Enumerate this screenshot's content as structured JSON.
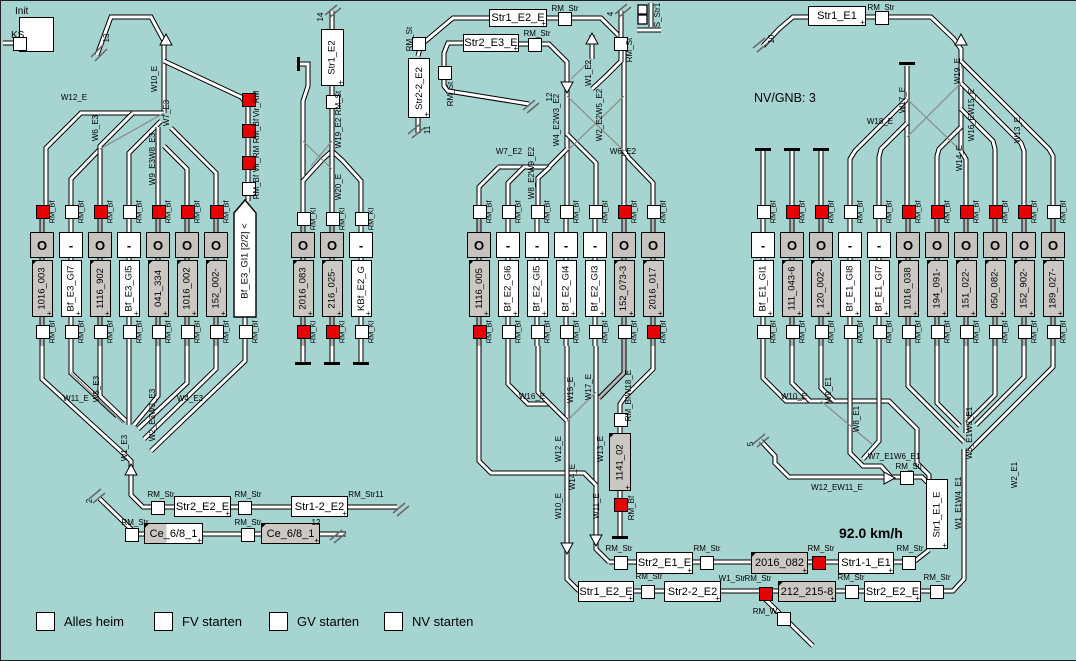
{
  "window": {
    "bg": "#a6d4d1",
    "accent_red": "#e60000",
    "track_gray": "#b3b3b3"
  },
  "controls": {
    "init": "Init",
    "ks": "KS",
    "buttons": [
      "Alles heim",
      "FV starten",
      "GV starten",
      "NV starten"
    ]
  },
  "texts": {
    "nv_gnb": "NV/GNB: 3",
    "speed": "92.0 km/h"
  },
  "deco": {
    "plus": "+",
    "wedge": "◤"
  },
  "stations": [
    {
      "id": "bf_e3",
      "x0": 41,
      "dx": 29,
      "y1": 204,
      "y2": 345,
      "sy": 210,
      "by": 330,
      "rm": "RM_Bf",
      "tracks": [
        {
          "label": "1016_003",
          "g": 1,
          "sig": "O",
          "top": "red",
          "bot": "white"
        },
        {
          "label": "Bf_E3_Gl7",
          "g": 0,
          "sig": "-",
          "top": "white",
          "bot": "white"
        },
        {
          "label": "1116_902",
          "g": 1,
          "sig": "O",
          "top": "red",
          "bot": "white"
        },
        {
          "label": "Bf_E3_Gl5",
          "g": 0,
          "sig": "-",
          "top": "white",
          "bot": "white"
        },
        {
          "label": "041_334",
          "g": 1,
          "sig": "O",
          "top": "red",
          "bot": "white"
        },
        {
          "label": "1016_002",
          "g": 1,
          "sig": "O",
          "top": "red",
          "bot": "white"
        },
        {
          "label": "152_002-",
          "g": 1,
          "sig": "O",
          "top": "red",
          "bot": "white"
        },
        {
          "label": "Bf_E3_Gl1 [2/2] <",
          "g": 0,
          "sig": "none",
          "top": "none",
          "bot": "white",
          "pent": 1
        }
      ]
    },
    {
      "id": "kbf_e2",
      "x0": 302,
      "dx": 29,
      "y1": 217,
      "y2": 345,
      "sy": 217,
      "by": 330,
      "rm": "RM_Kl",
      "tracks": [
        {
          "label": "2016_083",
          "g": 1,
          "sig": "O",
          "top": "white",
          "bot": "red"
        },
        {
          "label": "216_025-",
          "g": 1,
          "sig": "O",
          "top": "white",
          "bot": "red"
        },
        {
          "label": "KBf_E2_G",
          "g": 0,
          "sig": "-",
          "top": "white",
          "bot": "white"
        }
      ]
    },
    {
      "id": "bf_e2",
      "x0": 478,
      "dx": 29,
      "y1": 204,
      "y2": 345,
      "sy": 210,
      "by": 330,
      "rm": "RM_Bf",
      "tracks": [
        {
          "label": "1116_005",
          "g": 1,
          "sig": "O",
          "top": "white",
          "bot": "red"
        },
        {
          "label": "Bf_E2_Gl6",
          "g": 0,
          "sig": "-",
          "top": "white",
          "bot": "white"
        },
        {
          "label": "Bf_E2_Gl5",
          "g": 0,
          "sig": "-",
          "top": "white",
          "bot": "white"
        },
        {
          "label": "Bf_E2_Gl4",
          "g": 0,
          "sig": "-",
          "top": "white",
          "bot": "white"
        },
        {
          "label": "Bf_E2_Gl3",
          "g": 0,
          "sig": "-",
          "top": "white",
          "bot": "white"
        },
        {
          "label": "152_073-3",
          "g": 1,
          "sig": "O",
          "top": "red",
          "bot": "white"
        },
        {
          "label": "2016_017",
          "g": 1,
          "sig": "O",
          "top": "white",
          "bot": "red"
        }
      ]
    },
    {
      "id": "bf_e1",
      "x0": 762,
      "dx": 29,
      "y1": 204,
      "y2": 345,
      "sy": 210,
      "by": 330,
      "rm": "RM_Bf",
      "tracks": [
        {
          "label": "Bf_E1_Gl1",
          "g": 0,
          "sig": "-",
          "top": "white",
          "bot": "white"
        },
        {
          "label": "111_043-6",
          "g": 1,
          "sig": "O",
          "top": "red",
          "bot": "white"
        },
        {
          "label": "120_002-",
          "g": 1,
          "sig": "O",
          "top": "red",
          "bot": "white"
        },
        {
          "label": "Bf_E1_Gl8",
          "g": 0,
          "sig": "-",
          "top": "white",
          "bot": "white"
        },
        {
          "label": "Bf_E1_Gl7",
          "g": 0,
          "sig": "-",
          "top": "white",
          "bot": "white"
        },
        {
          "label": "1016_038",
          "g": 1,
          "sig": "O",
          "top": "red",
          "bot": "white"
        },
        {
          "label": "194_091-",
          "g": 1,
          "sig": "O",
          "top": "red",
          "bot": "white"
        },
        {
          "label": "151_022-",
          "g": 1,
          "sig": "O",
          "top": "red",
          "bot": "white"
        },
        {
          "label": "050_082-",
          "g": 1,
          "sig": "O",
          "top": "red",
          "bot": "white"
        },
        {
          "label": "152_902-",
          "g": 1,
          "sig": "O",
          "top": "red",
          "bot": "white"
        },
        {
          "label": "189_027-",
          "g": 1,
          "sig": "O",
          "top": "white",
          "bot": "white"
        }
      ]
    }
  ],
  "boxes": [
    {
      "t": "Str1_E2_E",
      "x": 488,
      "y": 8,
      "w": 58,
      "h": 18
    },
    {
      "t": "Str2_E3_E",
      "x": 462,
      "y": 33,
      "w": 56,
      "h": 18
    },
    {
      "t": "Str1_E1",
      "x": 807,
      "y": 5,
      "w": 58,
      "h": 20
    },
    {
      "t": "Str2_E1_E",
      "x": 635,
      "y": 551,
      "w": 57,
      "h": 22
    },
    {
      "t": "2016_082",
      "x": 750,
      "y": 551,
      "w": 57,
      "h": 22,
      "g": 1
    },
    {
      "t": "Str1-1_E1",
      "x": 837,
      "y": 551,
      "w": 56,
      "h": 22
    },
    {
      "t": "Str1_E2_E",
      "x": 577,
      "y": 580,
      "w": 56,
      "h": 21
    },
    {
      "t": "Str2-2_E2",
      "x": 663,
      "y": 580,
      "w": 57,
      "h": 21
    },
    {
      "t": "212_215-8",
      "x": 777,
      "y": 580,
      "w": 58,
      "h": 21,
      "g": 1
    },
    {
      "t": "Str2_E2_E",
      "x": 863,
      "y": 580,
      "w": 57,
      "h": 21
    },
    {
      "t": "Str2_E2_E",
      "x": 173,
      "y": 495,
      "w": 57,
      "h": 21
    },
    {
      "t": "Str1-2_E2",
      "x": 290,
      "y": 495,
      "w": 57,
      "h": 21
    },
    {
      "t": "Ce_6/8_1",
      "x": 143,
      "y": 522,
      "w": 59,
      "h": 21,
      "g": 2
    },
    {
      "t": "Ce_6/8_1",
      "x": 260,
      "y": 522,
      "w": 59,
      "h": 21,
      "g": 1
    },
    {
      "t": "Str1_E2",
      "x": 320,
      "y": 28,
      "w": 23,
      "h": 57,
      "v": 1
    },
    {
      "t": "Str2-2_E2",
      "x": 407,
      "y": 57,
      "w": 22,
      "h": 60,
      "v": 1
    },
    {
      "t": "1141_02",
      "x": 608,
      "y": 432,
      "w": 22,
      "h": 58,
      "v": 1,
      "g": 1
    },
    {
      "t": "Str1_E1_E",
      "x": 925,
      "y": 478,
      "w": 22,
      "h": 70,
      "v": 1
    }
  ],
  "squares": [
    [
      563,
      17,
      0
    ],
    [
      533,
      43,
      0
    ],
    [
      443,
      71,
      0
    ],
    [
      417,
      42,
      0
    ],
    [
      619,
      42,
      0
    ],
    [
      880,
      16,
      0
    ],
    [
      331,
      100,
      0
    ],
    [
      619,
      418,
      0
    ],
    [
      619,
      503,
      1
    ],
    [
      619,
      561,
      0
    ],
    [
      705,
      561,
      0
    ],
    [
      817,
      561,
      1
    ],
    [
      907,
      561,
      0
    ],
    [
      646,
      590,
      0
    ],
    [
      764,
      592,
      1
    ],
    [
      850,
      590,
      0
    ],
    [
      935,
      590,
      0
    ],
    [
      156,
      506,
      0
    ],
    [
      243,
      506,
      0
    ],
    [
      130,
      533,
      0
    ],
    [
      246,
      533,
      0
    ],
    [
      905,
      476,
      0
    ],
    [
      782,
      617,
      0
    ],
    [
      18,
      42,
      0
    ],
    [
      247,
      98,
      1
    ],
    [
      247,
      129,
      1
    ],
    [
      247,
      161,
      1
    ],
    [
      247,
      187,
      0
    ]
  ],
  "labels": [
    {
      "t": "W12_E",
      "x": 73,
      "y": 97
    },
    {
      "t": "W6_E3",
      "x": 95,
      "y": 127,
      "r": 1
    },
    {
      "t": "W10_E",
      "x": 154,
      "y": 78,
      "r": 1
    },
    {
      "t": "W7_E3",
      "x": 166,
      "y": 112,
      "r": 1
    },
    {
      "t": "W9_E3W8_E3",
      "x": 152,
      "y": 158,
      "r": 1
    },
    {
      "t": "13",
      "x": 106,
      "y": 37,
      "r": 1
    },
    {
      "t": "Vir_RM",
      "x": 256,
      "y": 103,
      "r": 1
    },
    {
      "t": "RM_Bf",
      "x": 256,
      "y": 130,
      "r": 1
    },
    {
      "t": "Vir_RM",
      "x": 256,
      "y": 158,
      "r": 1
    },
    {
      "t": "RM_Bf",
      "x": 256,
      "y": 186,
      "r": 1
    },
    {
      "t": "W11_E",
      "x": 75,
      "y": 398
    },
    {
      "t": "W5_E3",
      "x": 96,
      "y": 388,
      "r": 1
    },
    {
      "t": "W2_E3W3_E3",
      "x": 152,
      "y": 414,
      "r": 1
    },
    {
      "t": "W4_E3",
      "x": 189,
      "y": 398
    },
    {
      "t": "W1_E3",
      "x": 124,
      "y": 447,
      "r": 1
    },
    {
      "t": "2",
      "x": 89,
      "y": 500,
      "r": 1
    },
    {
      "t": "RM_Str",
      "x": 160,
      "y": 494
    },
    {
      "t": "RM_Str",
      "x": 247,
      "y": 494
    },
    {
      "t": "RM_Str11",
      "x": 365,
      "y": 494
    },
    {
      "t": "RM_Str",
      "x": 134,
      "y": 522
    },
    {
      "t": "RM_Str",
      "x": 247,
      "y": 522
    },
    {
      "t": "12",
      "x": 315,
      "y": 522
    },
    {
      "t": "14",
      "x": 320,
      "y": 16,
      "r": 1
    },
    {
      "t": "RM_St",
      "x": 338,
      "y": 102,
      "r": 1
    },
    {
      "t": "W19_E2",
      "x": 338,
      "y": 132,
      "r": 1
    },
    {
      "t": "W20_E",
      "x": 338,
      "y": 186,
      "r": 1
    },
    {
      "t": "RM_St",
      "x": 409,
      "y": 38,
      "r": 1
    },
    {
      "t": "11",
      "x": 427,
      "y": 129,
      "r": 1
    },
    {
      "t": "RM_Str",
      "x": 564,
      "y": 8
    },
    {
      "t": "RM_Str",
      "x": 536,
      "y": 33
    },
    {
      "t": "RM_St",
      "x": 450,
      "y": 93,
      "r": 1
    },
    {
      "t": "12",
      "x": 549,
      "y": 96,
      "r": 1
    },
    {
      "t": "4",
      "x": 610,
      "y": 13,
      "r": 1
    },
    {
      "t": "RM_St",
      "x": 629,
      "y": 49,
      "r": 1
    },
    {
      "t": "S_Str1",
      "x": 657,
      "y": 14,
      "r": 1
    },
    {
      "t": "W1_E2",
      "x": 588,
      "y": 72,
      "r": 1
    },
    {
      "t": "W2_E2W5_E2",
      "x": 599,
      "y": 114,
      "r": 1
    },
    {
      "t": "W4_E2W3_E2",
      "x": 556,
      "y": 119,
      "r": 1
    },
    {
      "t": "W8_E2W9_E2",
      "x": 531,
      "y": 172,
      "r": 1
    },
    {
      "t": "W7_E2",
      "x": 508,
      "y": 151
    },
    {
      "t": "W6_E2",
      "x": 622,
      "y": 151
    },
    {
      "t": "W16_E",
      "x": 531,
      "y": 396
    },
    {
      "t": "W15_E",
      "x": 570,
      "y": 389,
      "r": 1
    },
    {
      "t": "W17_E",
      "x": 588,
      "y": 386,
      "r": 1
    },
    {
      "t": "W12_E",
      "x": 558,
      "y": 448,
      "r": 1
    },
    {
      "t": "W14_E",
      "x": 572,
      "y": 476,
      "r": 1
    },
    {
      "t": "W13_E",
      "x": 600,
      "y": 448,
      "r": 1
    },
    {
      "t": "W10_E",
      "x": 558,
      "y": 505,
      "r": 1
    },
    {
      "t": "W11_E",
      "x": 596,
      "y": 505,
      "r": 1
    },
    {
      "t": "W18_E",
      "x": 628,
      "y": 382,
      "r": 1
    },
    {
      "t": "RM_Bf",
      "x": 628,
      "y": 408,
      "r": 1
    },
    {
      "t": "RM_Bf",
      "x": 631,
      "y": 507,
      "r": 1
    },
    {
      "t": "RM_Str",
      "x": 880,
      "y": 7
    },
    {
      "t": "10",
      "x": 771,
      "y": 38,
      "r": 1
    },
    {
      "t": "W18_E",
      "x": 879,
      "y": 121
    },
    {
      "t": "W17_E",
      "x": 902,
      "y": 99,
      "r": 1
    },
    {
      "t": "W19_E",
      "x": 957,
      "y": 70,
      "r": 1
    },
    {
      "t": "W16_EW15_E",
      "x": 971,
      "y": 114,
      "r": 1
    },
    {
      "t": "W14_E",
      "x": 959,
      "y": 157,
      "r": 1
    },
    {
      "t": "W13_E",
      "x": 1017,
      "y": 129,
      "r": 1
    },
    {
      "t": "W10_E",
      "x": 793,
      "y": 396
    },
    {
      "t": "W9_E1",
      "x": 828,
      "y": 389,
      "r": 1
    },
    {
      "t": "W8_E1",
      "x": 856,
      "y": 418,
      "r": 1
    },
    {
      "t": "W7_E1W6_E1",
      "x": 893,
      "y": 456
    },
    {
      "t": "RM_Str",
      "x": 908,
      "y": 466
    },
    {
      "t": "W12_EW11_E",
      "x": 836,
      "y": 487
    },
    {
      "t": "W5_E1W3_E1",
      "x": 969,
      "y": 432,
      "r": 1
    },
    {
      "t": "W1_E1W4_E1",
      "x": 958,
      "y": 502,
      "r": 1
    },
    {
      "t": "W2_E1",
      "x": 1014,
      "y": 474,
      "r": 1
    },
    {
      "t": "5",
      "x": 750,
      "y": 443,
      "r": 1
    },
    {
      "t": "RM_Str",
      "x": 618,
      "y": 548
    },
    {
      "t": "RM_Str",
      "x": 706,
      "y": 548
    },
    {
      "t": "RM_Str",
      "x": 820,
      "y": 548
    },
    {
      "t": "RM_Str",
      "x": 909,
      "y": 548
    },
    {
      "t": "RM_Str",
      "x": 648,
      "y": 576
    },
    {
      "t": "W1_Str",
      "x": 731,
      "y": 578
    },
    {
      "t": "RM_Str",
      "x": 757,
      "y": 578
    },
    {
      "t": "RM_Str",
      "x": 850,
      "y": 577
    },
    {
      "t": "RM_Str",
      "x": 936,
      "y": 577
    },
    {
      "t": "RM_W",
      "x": 764,
      "y": 611
    }
  ]
}
